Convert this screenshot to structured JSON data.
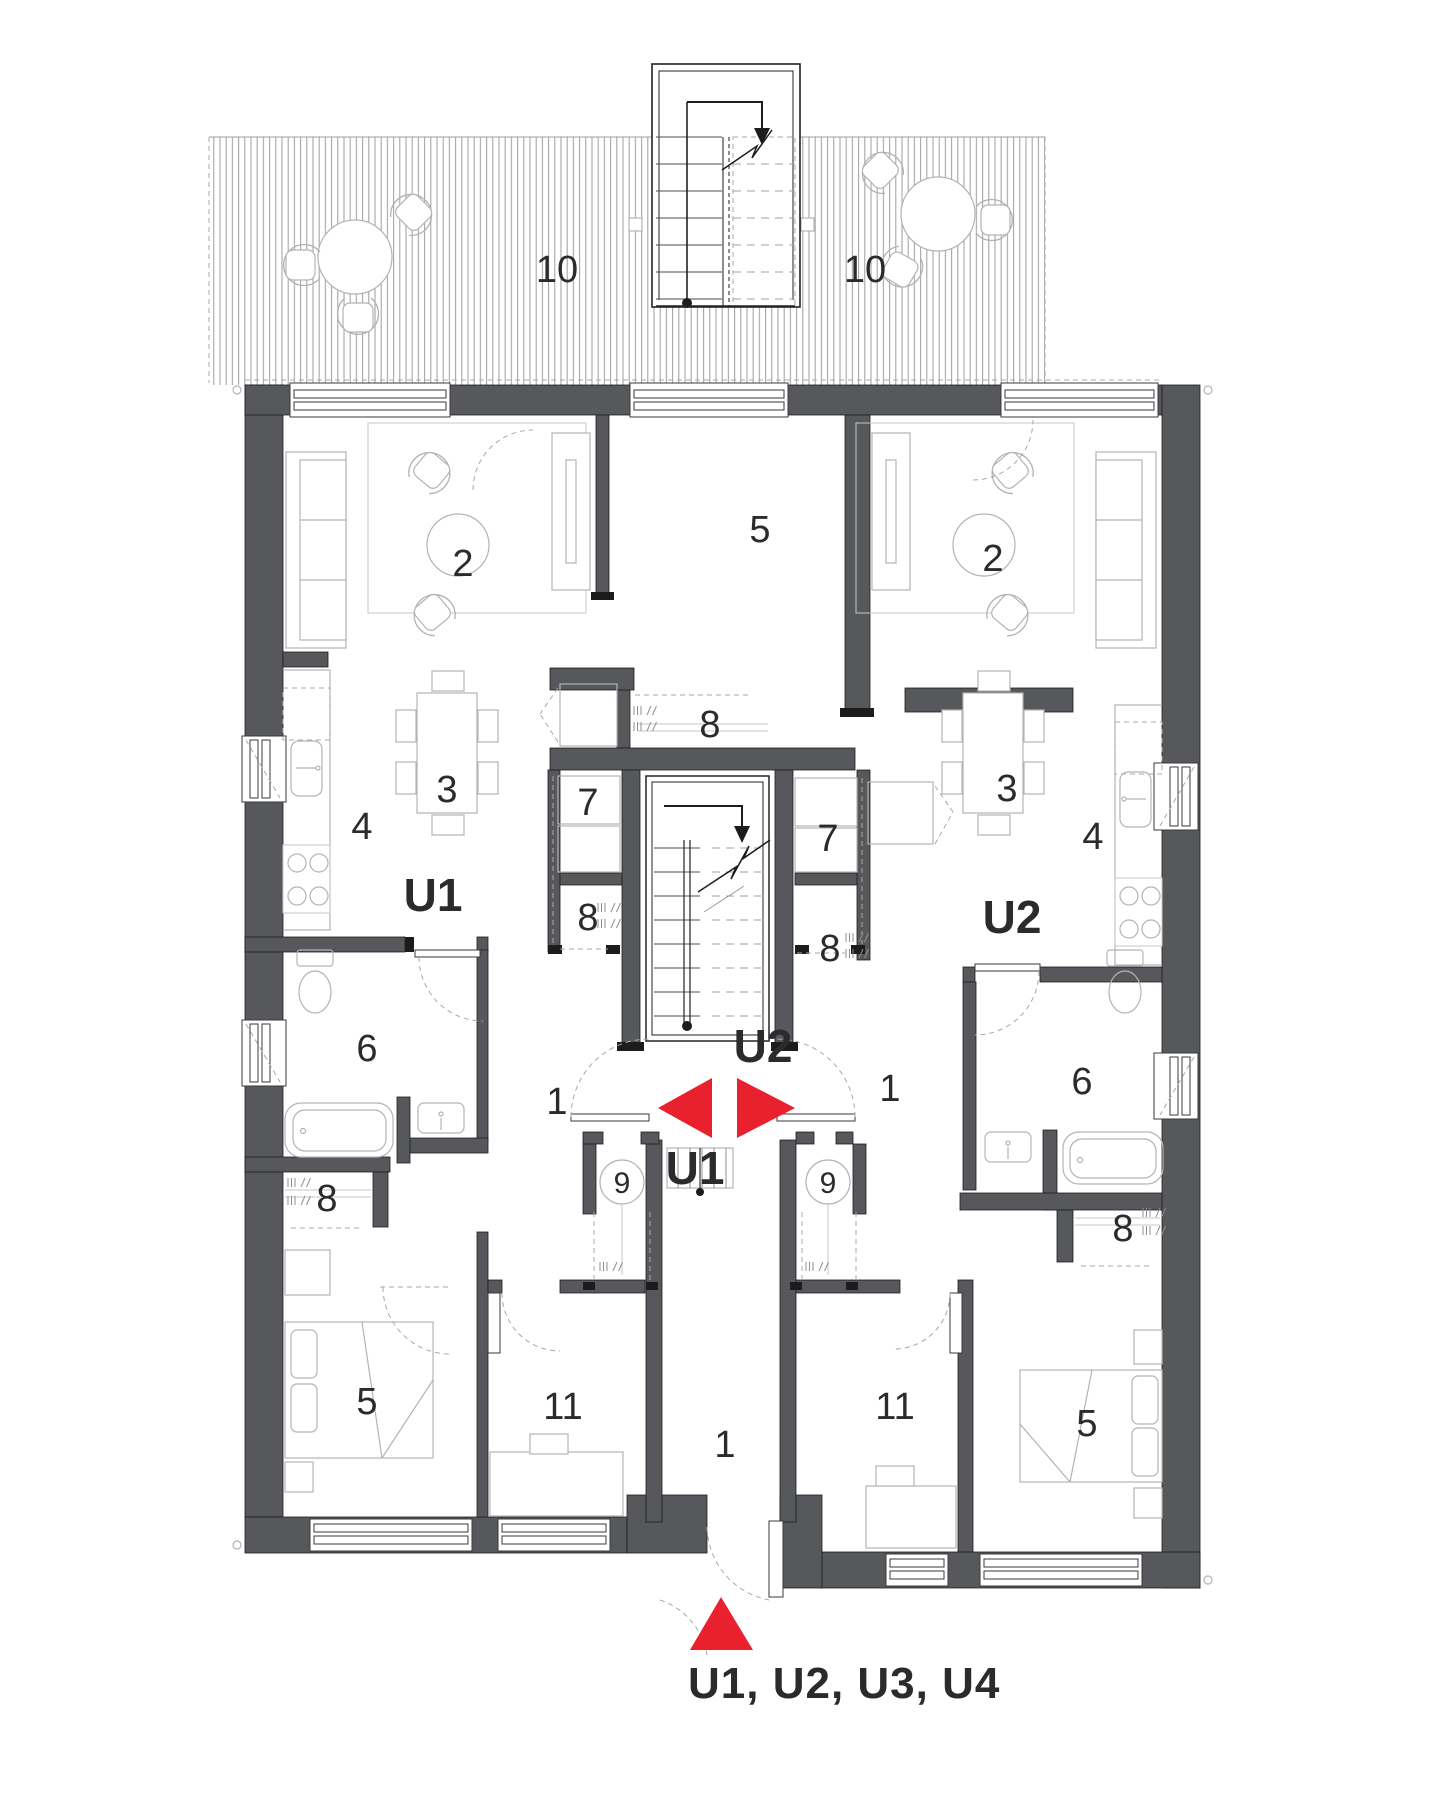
{
  "colors": {
    "wall": "#57585b",
    "red": "#e9212e",
    "ink": "#2b2a2c",
    "furn": "#b3b3b3"
  },
  "labels": {
    "deck_left": "10",
    "deck_right": "10",
    "living_left": "2",
    "living_right": "2",
    "bedroom_top": "5",
    "bedroom_bottom_left": "5",
    "bedroom_bottom_right": "5",
    "dining_left": "3",
    "dining_right": "3",
    "kitchen_left": "4",
    "kitchen_right": "4",
    "bath_left": "6",
    "bath_right": "6",
    "closet7_left": "7",
    "closet7_right": "7",
    "hall8_u2": "8",
    "closet8_left": "8",
    "closet8_right": "8",
    "laundry_left": "8",
    "laundry_right": "8",
    "heater_left": "9",
    "heater_right": "9",
    "room11_left": "11",
    "room11_right": "11",
    "entry_left": "1",
    "entry_right": "1",
    "corridor": "1",
    "unit_tag_left": "U1",
    "unit_tag_right": "U2",
    "center_tag_u2": "U2",
    "center_tag_u1": "U1",
    "entrance_title": "U1, U2, U3, U4"
  }
}
